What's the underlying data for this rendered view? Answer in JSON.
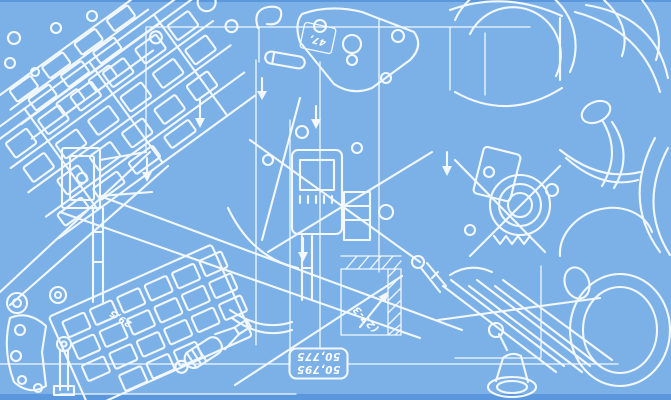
{
  "palette": {
    "background": "#7CB1E8",
    "background_edge": "#5B97DD",
    "line": "#F2F8FE"
  },
  "labels": {
    "dim_box_line1": "50,795",
    "dim_box_line2": "50,775",
    "dim_detail_diagonal": "(27-3",
    "dim_left_diagonal": "29,5",
    "dim_top_tag": "47,"
  }
}
